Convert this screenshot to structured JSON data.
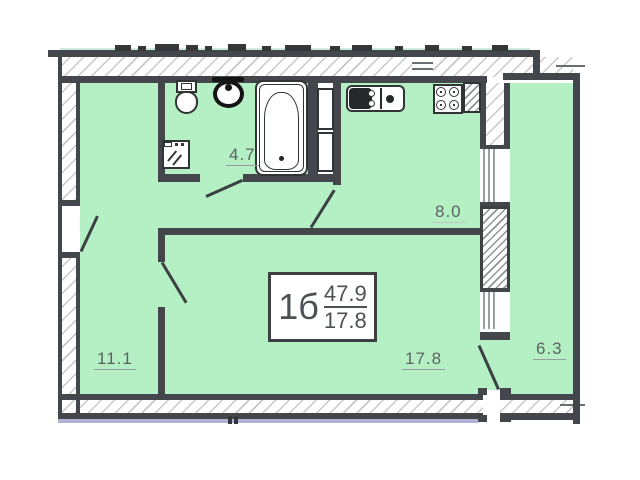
{
  "plan": {
    "title": "apartment-floor-plan",
    "stamp": {
      "type": "1б",
      "total_area": "47.9",
      "living_area": "17.8"
    },
    "rooms": [
      {
        "name": "bathroom",
        "area": "4.7"
      },
      {
        "name": "kitchen",
        "area": "8.0"
      },
      {
        "name": "hallway",
        "area": "11.1"
      },
      {
        "name": "living-room",
        "area": "17.8"
      },
      {
        "name": "balcony",
        "area": "6.3"
      }
    ],
    "fixtures": [
      "toilet-icon",
      "washbasin-icon",
      "washing-machine-icon",
      "bathtub-icon",
      "kitchen-sink-icon",
      "stove-icon",
      "vent-shaft-icon"
    ],
    "doors": [
      "entrance-door",
      "bathroom-door",
      "kitchen-door",
      "living-room-door",
      "balcony-door"
    ],
    "windows": [
      "kitchen-balcony-window",
      "living-room-balcony-window"
    ],
    "colors": {
      "room_fill": "#b5f0c4",
      "wall": "#43464a",
      "accent_line": "#cde9e0",
      "plinth_line": "#b2b0d4"
    }
  }
}
